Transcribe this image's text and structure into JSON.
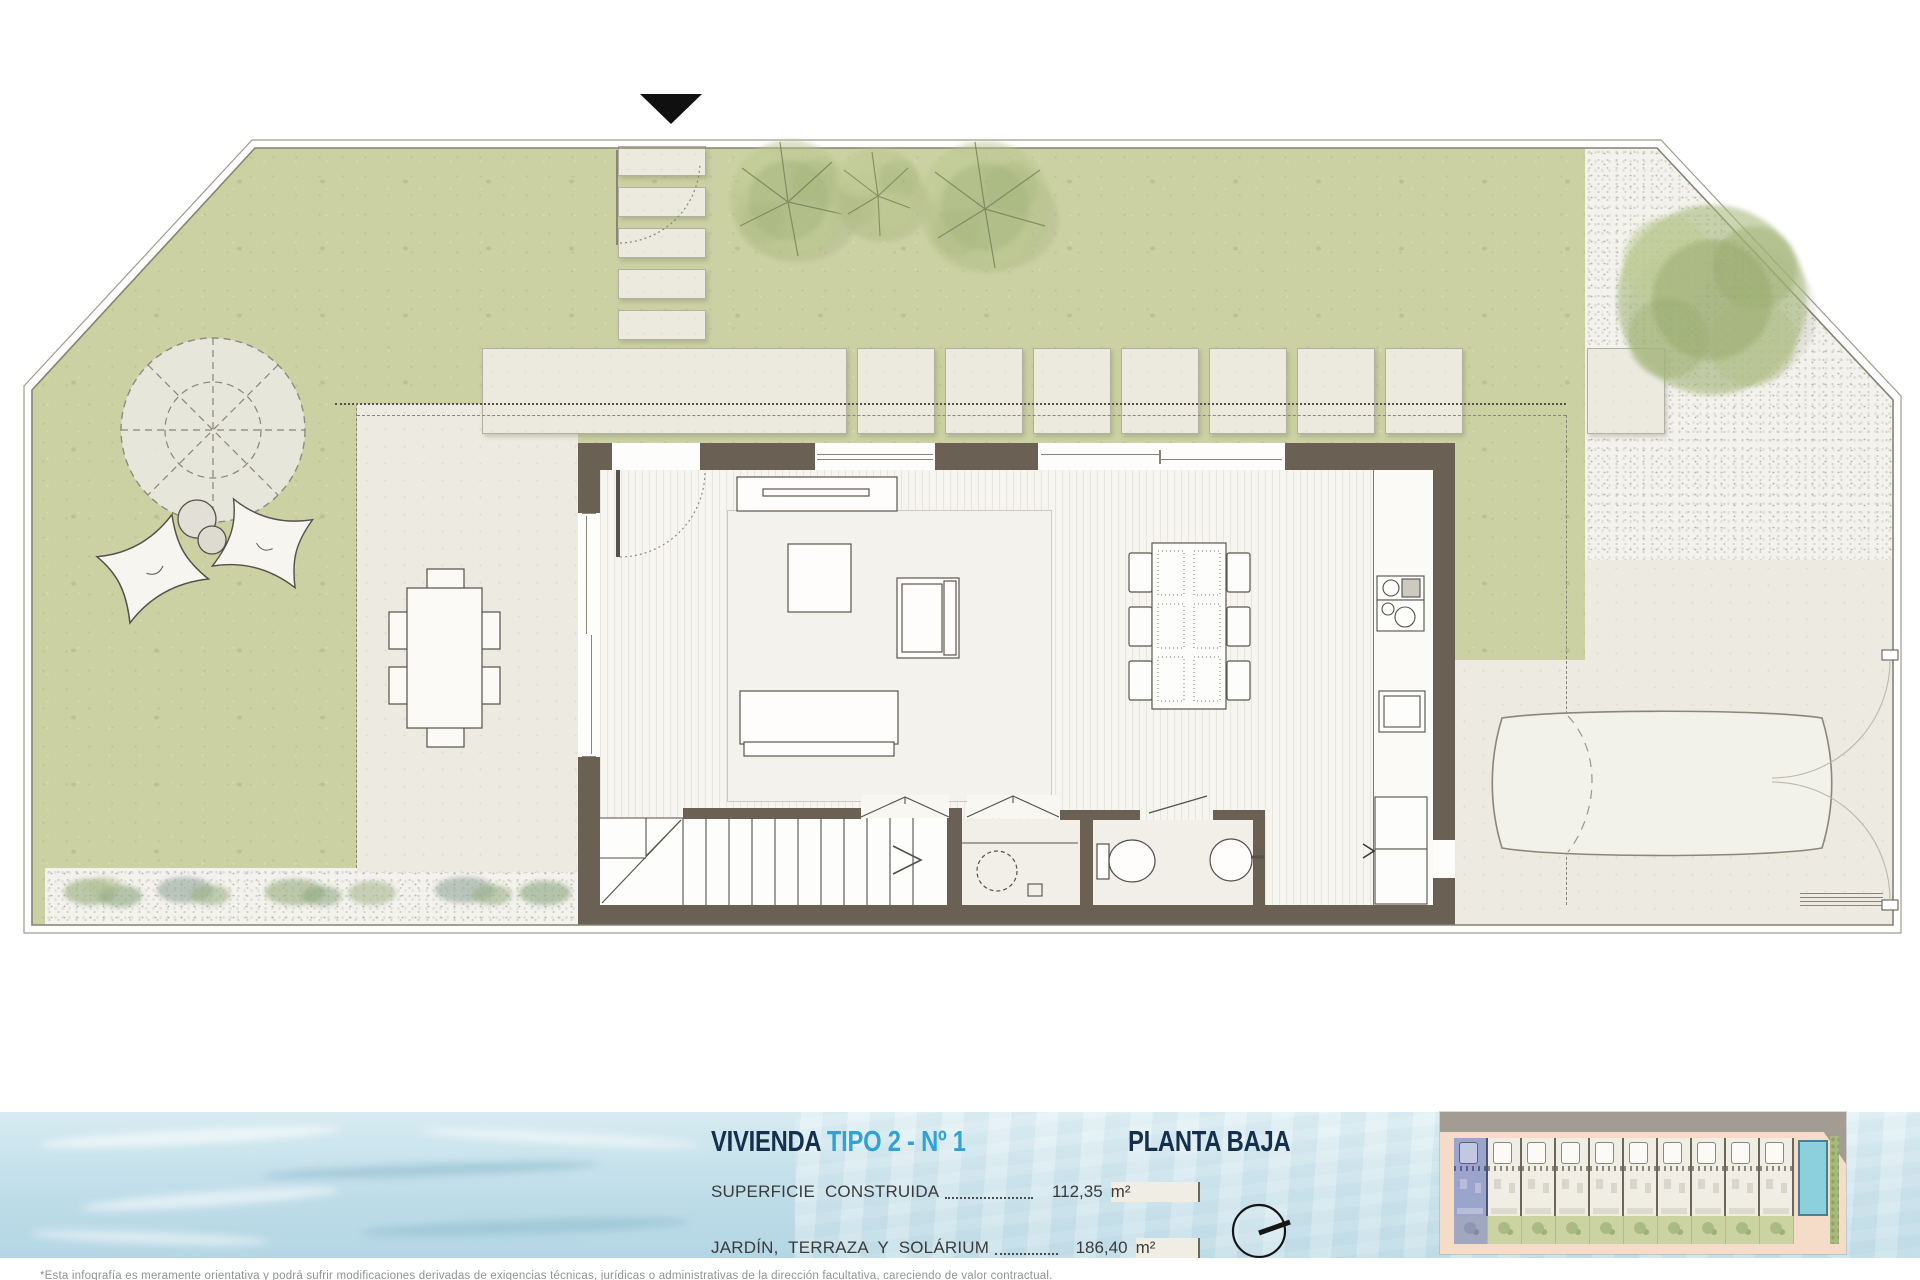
{
  "header": {
    "project": "VIVIENDA",
    "variant": "TIPO 2 - Nº 1",
    "floor_label": "PLANTA BAJA"
  },
  "areas": [
    {
      "label": "SUPERFICIE  CONSTRUIDA",
      "value": "112,35",
      "unit": "m²"
    },
    {
      "label": "JARDÍN,  TERRAZA  Y  SOLÁRIUM",
      "value": "186,40",
      "unit": "m²"
    }
  ],
  "disclaimer": "*Esta infografía es meramente orientativa y podrá sufrir modificaciones derivadas de exigencias técnicas, jurídicas o administrativas de la dirección facultativa, careciendo de valor contractual.",
  "plan": {
    "type": "floor-plan",
    "north_arrow": "triangle-down",
    "compass_icon": "circle-with-needle"
  },
  "site_thumbnail": {
    "units": 10,
    "highlighted_unit": 1,
    "features": [
      "road",
      "parking",
      "gardens",
      "pool",
      "hedge"
    ]
  },
  "colors": {
    "title_navy": "#14304c",
    "accent_cyan": "#2fa2d8",
    "grass": "#cbd1a3",
    "paving": "#edebe1",
    "wall": "#6a6154",
    "water_band": "#d3e7ee",
    "thumbnail_highlight": "#9ba4cd"
  }
}
